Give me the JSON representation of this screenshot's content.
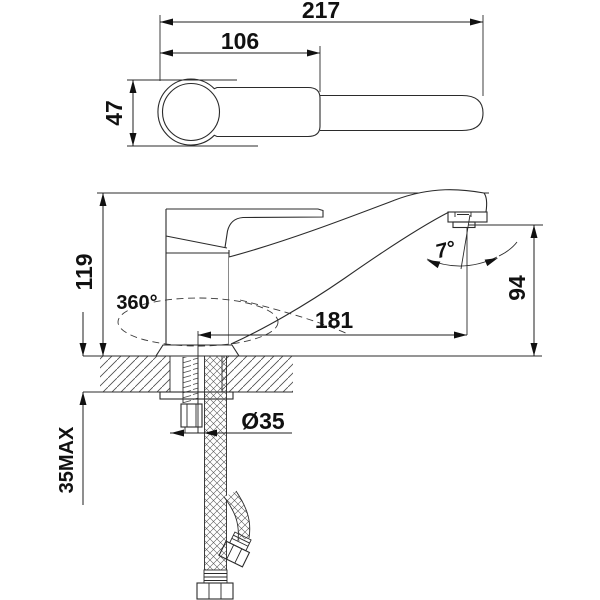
{
  "drawing": {
    "type": "technical-drawing",
    "subject": "single-lever kitchen faucet, dimensioned installation drawing, top view and front view",
    "line_color": "#2b2b2b",
    "background": "#ffffff",
    "labels": {
      "overall_length": "217",
      "handle_length": "106",
      "body_width": "47",
      "height_to_top": "119",
      "swivel_angle": "360°",
      "spout_reach": "181",
      "spout_outlet_height": "94",
      "outlet_angle": "7°",
      "hole_diameter": "Ø35",
      "max_deck_thickness": "35MAX"
    }
  }
}
